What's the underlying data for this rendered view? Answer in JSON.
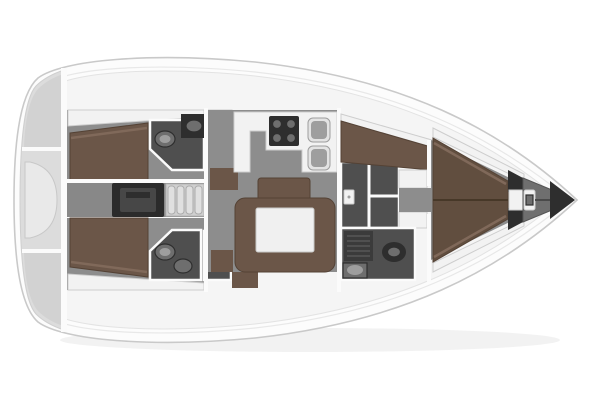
{
  "canvas": {
    "width": 600,
    "height": 400
  },
  "diagram": {
    "kind": "yacht-interior-deck-plan",
    "orientation": {
      "bow": "right",
      "stern": "left"
    }
  },
  "colors": {
    "background": "#ffffff",
    "hull_fill": "#fcfcfc",
    "hull_stroke": "#c9c9c9",
    "sheer_stroke": "#e8e8e8",
    "deck_fill": "#f5f5f5",
    "deck_stroke": "#e3e3e3",
    "shadow_col": "rgba(0,0,0,0.05)",
    "floor_gray": "#8d8d8d",
    "floor_mid": "#888888",
    "wood_brown": "#6b5648",
    "wood_brown_dark": "#544235",
    "wood_trim": "#80695a",
    "bed_fwd": "#614e3f",
    "bath_dark": "#4f4f4f",
    "shower_dark": "#3b3b3b",
    "slat_line": "#575757",
    "fixture_dark": "#2e2e2e",
    "fixture_mid": "#6e6e6e",
    "white_furniture": "#f2f2f2",
    "furniture_stroke": "#cdcdcd",
    "wall_white": "#fbfbfb",
    "engine_dark": "#2b2b2b",
    "engine_inner": "#474747",
    "steps_light": "#cfcfcf",
    "step_tread": "#e0e0e0",
    "stern_gray": "#dcdcdc",
    "stern_dark": "#d2d2d2",
    "stern_light": "#e9e9e9",
    "locker_gray": "#6f6f6f",
    "tip_dark": "#2e2e2e",
    "sink_rim": "#e3e3e3",
    "sink_basin": "#9e9e9e"
  },
  "regions": [
    {
      "id": "stern-platform"
    },
    {
      "id": "aft-cabin-starboard"
    },
    {
      "id": "aft-head-starboard"
    },
    {
      "id": "companionway"
    },
    {
      "id": "engine-compartment"
    },
    {
      "id": "aft-cabin-port"
    },
    {
      "id": "aft-head-port"
    },
    {
      "id": "salon"
    },
    {
      "id": "galley"
    },
    {
      "id": "dinette"
    },
    {
      "id": "nav-area"
    },
    {
      "id": "forward-head"
    },
    {
      "id": "forward-cabin"
    },
    {
      "id": "anchor-locker"
    },
    {
      "id": "bow-tip"
    }
  ],
  "fixtures": [
    "double-bed",
    "v-berth",
    "settee",
    "dinette-table",
    "sideboard",
    "stove",
    "galley-sink",
    "toilet",
    "washbasin",
    "shower",
    "engine-box",
    "companionway-steps",
    "windlass",
    "anchor-chain",
    "bench",
    "locker",
    "wardrobe",
    "electrical-panel"
  ]
}
